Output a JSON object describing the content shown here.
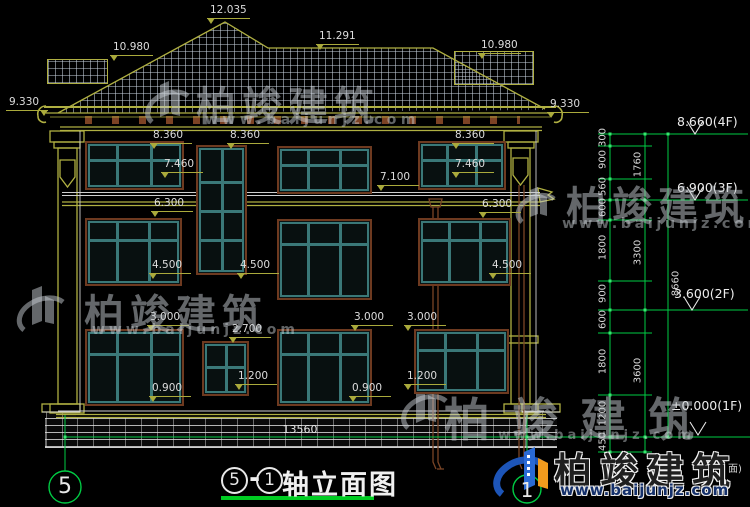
{
  "drawing": {
    "title": {
      "axis_start": "5",
      "dash": "-",
      "axis_end": "1",
      "name": "轴立面图"
    },
    "axis_bubbles": {
      "left": "5",
      "right": "1"
    },
    "overall_width_dim": "13560",
    "edge_text": "面)"
  },
  "dims": [
    {
      "text": "12.035"
    },
    {
      "text": "10.980"
    },
    {
      "text": "11.291"
    },
    {
      "text": "10.980"
    },
    {
      "text": "9.330"
    },
    {
      "text": "9.330"
    },
    {
      "text": "8.360"
    },
    {
      "text": "8.360"
    },
    {
      "text": "8.360"
    },
    {
      "text": "7.460"
    },
    {
      "text": "7.460"
    },
    {
      "text": "7.100"
    },
    {
      "text": "6.300"
    },
    {
      "text": "6.300"
    },
    {
      "text": "4.500"
    },
    {
      "text": "4.500"
    },
    {
      "text": "4.500"
    },
    {
      "text": "3.000"
    },
    {
      "text": "3.000"
    },
    {
      "text": "3.000"
    },
    {
      "text": "2.700"
    },
    {
      "text": "1.200"
    },
    {
      "text": "1.200"
    },
    {
      "text": "0.900"
    },
    {
      "text": "0.900"
    }
  ],
  "floor_markers": [
    {
      "text": "8.660(4F)"
    },
    {
      "text": "6.900(3F)"
    },
    {
      "text": "3.600(2F)"
    },
    {
      "text": "±0.000(1F)"
    }
  ],
  "chain": {
    "col1": [
      "300",
      "900",
      "560",
      "600",
      "1800",
      "900",
      "600",
      "1800",
      "1200",
      "450"
    ],
    "col2": [
      "1760",
      "3300",
      "3600"
    ],
    "col3": [
      "8660"
    ]
  },
  "watermark": {
    "brand": "柏竣建筑",
    "url": "www.baijunjz.com"
  },
  "footer_logo": {
    "brand": "柏竣建筑",
    "url": "www.baijunjz.com"
  },
  "colors": {
    "cad_olive": "#b0b042",
    "dim_green": "#00cc44",
    "window_teal": "#3a7878",
    "trim_brown": "#6e3a20",
    "logo_blue": "#1d55b8",
    "logo_orange": "#f29b1d"
  }
}
